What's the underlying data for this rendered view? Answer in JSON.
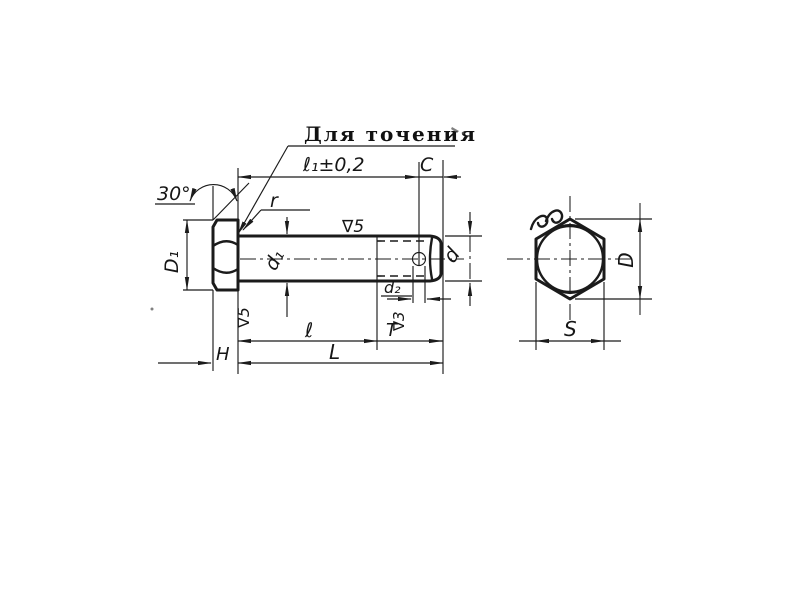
{
  "drawing": {
    "kind": "hex-head bolt, two views",
    "colors": {
      "ink": "#1b1b1b",
      "paper": "#ffffff"
    },
    "labels": {
      "note": "Для точения",
      "angle": "30°",
      "head_diameter": "D₁",
      "fillet_radius": "r",
      "turned_length": "ℓ₁±0,2",
      "end_chamfer": "C",
      "shank_diameter": "d₁",
      "shank_finish": "∇5",
      "bolt_diameter": "d",
      "hole_diameter": "d₂",
      "thread_finish": "∇3",
      "thread_length": "T",
      "grip_length": "ℓ",
      "bearing_finish": "∇5",
      "head_height": "H",
      "shank_length": "L",
      "across_corners": "D",
      "across_flats": "S"
    }
  }
}
